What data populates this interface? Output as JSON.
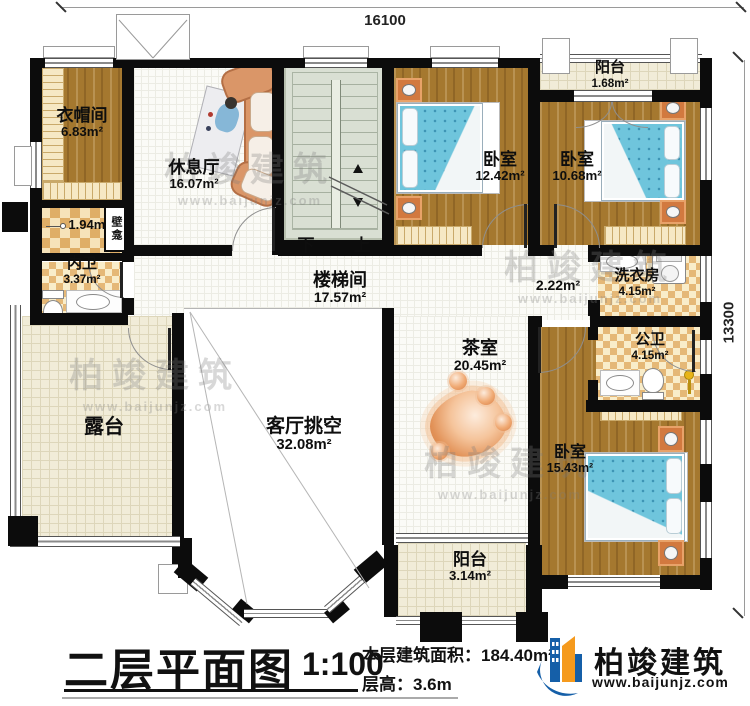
{
  "dimensions": {
    "width_mm": "16100",
    "depth_mm": "13300"
  },
  "rooms": {
    "cloakroom": {
      "name": "衣帽间",
      "area": "6.83m²"
    },
    "lounge": {
      "name": "休息厅",
      "area": "16.07m²"
    },
    "wall_niche": {
      "name": "壁龛"
    },
    "closet": {
      "area": "1.94m²"
    },
    "inner_bath": {
      "name": "内卫",
      "area": "3.37m²"
    },
    "terrace": {
      "name": "露台"
    },
    "stair_hall": {
      "name": "楼梯间",
      "area": "17.57m²"
    },
    "corridor": {
      "area": "2.22m²"
    },
    "living_room_void": {
      "name": "客厅挑空",
      "area": "32.08m²"
    },
    "tea_room": {
      "name": "茶室",
      "area": "20.45m²"
    },
    "bedroom_left": {
      "name": "卧室",
      "area": "12.42m²"
    },
    "bedroom_mid": {
      "name": "卧室",
      "area": "10.68m²"
    },
    "bedroom_bottom": {
      "name": "卧室",
      "area": "15.43m²"
    },
    "balcony_top": {
      "name": "阳台",
      "area": "1.68m²"
    },
    "balcony_bottom": {
      "name": "阳台",
      "area": "3.14m²"
    },
    "laundry": {
      "name": "洗衣房",
      "area": "4.15m²"
    },
    "public_bath": {
      "name": "公卫",
      "area": "4.15m²"
    }
  },
  "stairs": {
    "down_label": "下",
    "up_label": "上"
  },
  "legend": {
    "title": "二层平面图",
    "scale": "1:100",
    "floor_area_label": "本层建筑面积：",
    "floor_area_value": "184.40m²",
    "floor_height_label": "层高：",
    "floor_height_value": "3.6m"
  },
  "brand": {
    "name": "柏竣建筑",
    "website": "www.baijunjz.com"
  },
  "watermark": {
    "name": "柏竣建筑",
    "website": "www.baijunjz.com"
  },
  "colors": {
    "wall": "#0c0c0c",
    "wood_floor": "#a5782f",
    "tile_light": "#f9edca",
    "tile_dark": "#e5b877",
    "stair_floor": "#d9dfd3",
    "terrace_floor": "#f1ecd8",
    "bed_blue": "#6fc5dc",
    "furniture_orange": "#d2793f",
    "logo_blue": "#155fa8",
    "logo_orange": "#f59a1d"
  }
}
